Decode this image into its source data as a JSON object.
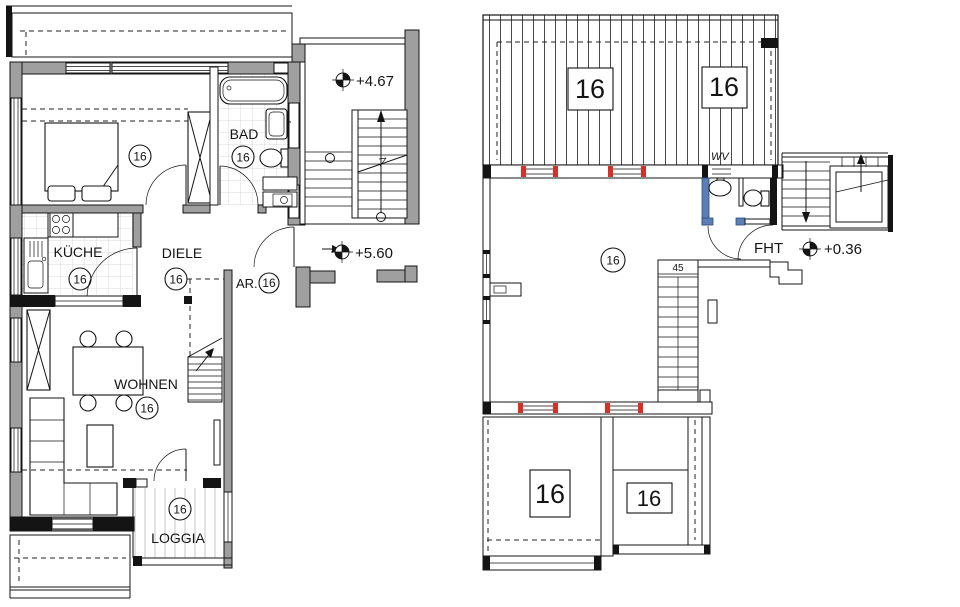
{
  "drawing_type": "architectural floor plan, two storeys of a maisonette flat",
  "colors": {
    "wall_gray": "#9f9f9f",
    "line": "#141414",
    "window_marker_red": "#d93025",
    "wet_wall_blue": "#5b7fb5",
    "hatch": "#4a4a4a"
  },
  "left_plan": {
    "bedroom": {
      "unit": "16"
    },
    "bathroom": {
      "label": "BAD",
      "unit": "16"
    },
    "kitchen": {
      "label": "KÜCHE",
      "unit": "16"
    },
    "hallway": {
      "label": "DIELE",
      "unit": "16"
    },
    "storage": {
      "label": "AR.",
      "unit": "16"
    },
    "living": {
      "label": "WOHNEN",
      "unit": "16"
    },
    "loggia": {
      "label": "LOGGIA",
      "unit": "16"
    },
    "levels": {
      "upper": "+4.67",
      "lower": "+5.60"
    }
  },
  "right_plan": {
    "roof_top": {
      "unit_left": "16",
      "unit_right": "16"
    },
    "room": {
      "unit": "16"
    },
    "stair_width": "45",
    "entry_door": "FHT",
    "vent": "WV",
    "level": "+0.36",
    "roof_bottom": {
      "unit_left": "16",
      "unit_right": "16"
    }
  }
}
